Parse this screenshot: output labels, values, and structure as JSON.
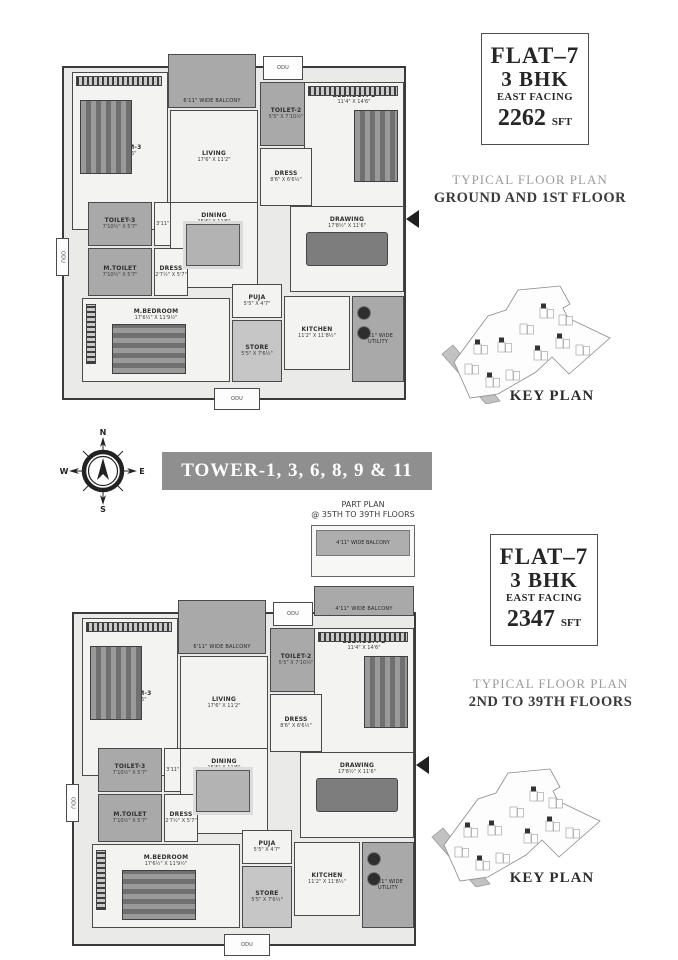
{
  "flats": [
    {
      "name": "FLAT–7",
      "bhk": "3 BHK",
      "facing": "EAST FACING",
      "area": "2262",
      "unit": "SFT",
      "plan_type": "TYPICAL FLOOR PLAN",
      "floors": "GROUND AND 1ST FLOOR"
    },
    {
      "name": "FLAT–7",
      "bhk": "3 BHK",
      "facing": "EAST FACING",
      "area": "2347",
      "unit": "SFT",
      "plan_type": "TYPICAL FLOOR PLAN",
      "floors": "2ND TO 39TH FLOORS"
    }
  ],
  "tower_banner": {
    "label": "TOWER-1, 3, 6, 8, 9 & 11"
  },
  "compass": {
    "north": "N",
    "east": "E",
    "south": "S",
    "west": "W"
  },
  "part_plan": {
    "title": "PART PLAN",
    "subtitle": "@ 35TH TO 39TH FLOORS",
    "balcony": "4'11\" WIDE BALCONY"
  },
  "key_plan": {
    "title": "KEY PLAN",
    "road": "100' WIDE ROAD"
  },
  "colors": {
    "banner_gray": "#8f8f8f",
    "plan_gray": "#a9a9a9",
    "text_dark": "#262626",
    "caption_gray": "#9b9b9b"
  },
  "plans": [
    {
      "rooms": {
        "bedroom3": {
          "name": "BEDROOM-3",
          "dims": "11'6\" X 14'6\""
        },
        "toilet3": {
          "name": "TOILET-3",
          "dims": "7'10½\" X 5'7\""
        },
        "passage3": {
          "dims": "3'11\" X 5'7\""
        },
        "living": {
          "name": "LIVING",
          "dims": "17'6\" X 11'2\""
        },
        "balcony_living": {
          "name": "6'11\" WIDE BALCONY"
        },
        "odu_top": {
          "name": "ODU"
        },
        "odu_bottom": {
          "name": "ODU"
        },
        "odu_left": {
          "name": "ODU"
        },
        "toilet2": {
          "name": "TOILET-2",
          "dims": "5'5\" X 7'10½\""
        },
        "bedroom2": {
          "name": "BEDROOM-2",
          "dims": "11'4\" X 14'6\""
        },
        "dress2": {
          "name": "DRESS",
          "dims": "8'6\" X 6'6½\""
        },
        "dining": {
          "name": "DINING",
          "dims": "15'5\" X 11'6\""
        },
        "drawing": {
          "name": "DRAWING",
          "dims": "17'8½\" X 11'6\""
        },
        "mtoilet": {
          "name": "M.TOILET",
          "dims": "7'10½\" X 5'7\""
        },
        "dressm": {
          "name": "DRESS",
          "dims": "2'7½\" X 5'7\""
        },
        "mbedroom": {
          "name": "M.BEDROOM",
          "dims": "17'6½\" X 11'9½\""
        },
        "puja": {
          "name": "PUJA",
          "dims": "5'5\" X 4'7\""
        },
        "store": {
          "name": "STORE",
          "dims": "5'5\" X 7'6½\""
        },
        "kitchen": {
          "name": "KITCHEN",
          "dims": "11'2\" X 11'8½\""
        },
        "utility": {
          "name": "5'11\" WIDE UTILITY"
        }
      }
    },
    {
      "rooms": {
        "balcony_top": {
          "name": "4'11\" WIDE BALCONY"
        },
        "bedroom3": {
          "name": "BEDROOM-3",
          "dims": "11'6\" X 14'6\""
        },
        "toilet3": {
          "name": "TOILET-3",
          "dims": "7'10½\" X 5'7\""
        },
        "passage3": {
          "dims": "3'11\" X 5'7\""
        },
        "living": {
          "name": "LIVING",
          "dims": "17'6\" X 11'2\""
        },
        "balcony_living": {
          "name": "6'11\" WIDE BALCONY"
        },
        "odu_top": {
          "name": "ODU"
        },
        "odu_bottom": {
          "name": "ODU"
        },
        "odu_left": {
          "name": "ODU"
        },
        "toilet2": {
          "name": "TOILET-2",
          "dims": "5'5\" X 7'10½\""
        },
        "bedroom2": {
          "name": "BEDROOM-2",
          "dims": "11'4\" X 14'6\""
        },
        "dress2": {
          "name": "DRESS",
          "dims": "8'6\" X 6'6½\""
        },
        "dining": {
          "name": "DINING",
          "dims": "15'5\" X 11'6\""
        },
        "drawing": {
          "name": "DRAWING",
          "dims": "17'8½\" X 11'6\""
        },
        "mtoilet": {
          "name": "M.TOILET",
          "dims": "7'10½\" X 5'7\""
        },
        "dressm": {
          "name": "DRESS",
          "dims": "2'7½\" X 5'7\""
        },
        "mbedroom": {
          "name": "M.BEDROOM",
          "dims": "17'6½\" X 11'9½\""
        },
        "puja": {
          "name": "PUJA",
          "dims": "5'5\" X 4'7\""
        },
        "store": {
          "name": "STORE",
          "dims": "5'5\" X 7'6½\""
        },
        "kitchen": {
          "name": "KITCHEN",
          "dims": "11'2\" X 11'8½\""
        },
        "utility": {
          "name": "5'11\" WIDE UTILITY"
        }
      }
    }
  ]
}
